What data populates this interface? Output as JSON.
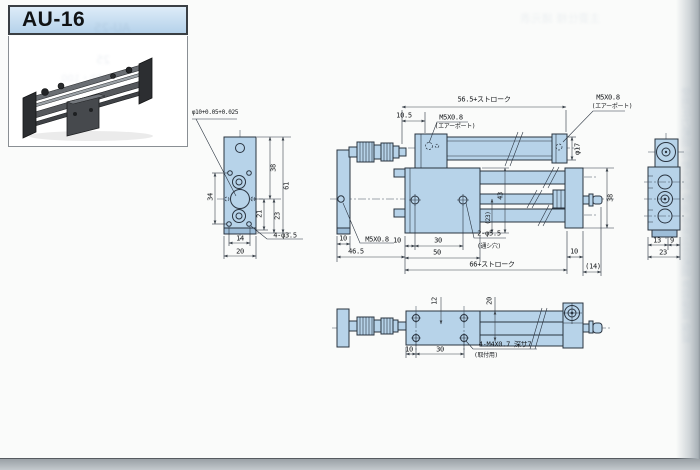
{
  "page": {
    "title": "AU-16"
  },
  "colors": {
    "line": "#2a3440",
    "dim": "#3c444c",
    "fill": "#b7d3e9",
    "fill2": "#9dbdd8",
    "page": "#fafbfa",
    "banner1": "#ddecf8",
    "banner2": "#b5d2ea",
    "ghost": "#7b93ae"
  },
  "labels": [
    {
      "t": "φ10+0.05+0.025",
      "x": 215,
      "y": 113,
      "s": 6
    },
    {
      "t": "34",
      "x": 211,
      "y": 197,
      "r": 1
    },
    {
      "t": "38",
      "x": 274,
      "y": 168,
      "r": 1
    },
    {
      "t": "61",
      "x": 287,
      "y": 186,
      "r": 1
    },
    {
      "t": "21",
      "x": 260,
      "y": 214,
      "r": 1
    },
    {
      "t": "23",
      "x": 278,
      "y": 216,
      "r": 1
    },
    {
      "t": "14",
      "x": 240,
      "y": 239
    },
    {
      "t": "20",
      "x": 240,
      "y": 252
    },
    {
      "t": "4-φ3.5",
      "x": 285,
      "y": 236
    },
    {
      "t": "56.5+ストローク",
      "x": 484,
      "y": 100
    },
    {
      "t": "10.5",
      "x": 404,
      "y": 116
    },
    {
      "t": "M5X0.8",
      "x": 451,
      "y": 118
    },
    {
      "t": "(エアーポート)",
      "x": 455,
      "y": 127,
      "s": 6
    },
    {
      "t": "M5X0.8",
      "x": 608,
      "y": 98
    },
    {
      "t": "(エアーポート)",
      "x": 612,
      "y": 107,
      "s": 6
    },
    {
      "t": "φ17",
      "x": 578,
      "y": 149,
      "r": 1
    },
    {
      "t": "10",
      "x": 343,
      "y": 239
    },
    {
      "t": "M5X0.8",
      "x": 377,
      "y": 240
    },
    {
      "t": "46.5",
      "x": 356,
      "y": 252
    },
    {
      "t": "10",
      "x": 397,
      "y": 241
    },
    {
      "t": "30",
      "x": 438,
      "y": 241
    },
    {
      "t": "50",
      "x": 437,
      "y": 253
    },
    {
      "t": "2-φ5.5",
      "x": 489,
      "y": 234
    },
    {
      "t": "(通シ穴)",
      "x": 489,
      "y": 247,
      "s": 6
    },
    {
      "t": "66+ストローク",
      "x": 492,
      "y": 265
    },
    {
      "t": "43",
      "x": 501,
      "y": 196,
      "r": 1
    },
    {
      "t": "(23)",
      "x": 489,
      "y": 218,
      "r": 1,
      "s": 6
    },
    {
      "t": "38",
      "x": 611,
      "y": 198,
      "r": 1
    },
    {
      "t": "10",
      "x": 574,
      "y": 252
    },
    {
      "t": "(14)",
      "x": 593,
      "y": 267
    },
    {
      "t": "13",
      "x": 657,
      "y": 241
    },
    {
      "t": "9",
      "x": 672,
      "y": 241
    },
    {
      "t": "23",
      "x": 663,
      "y": 253
    },
    {
      "t": "12",
      "x": 435,
      "y": 301,
      "r": 1
    },
    {
      "t": "20",
      "x": 490,
      "y": 301,
      "r": 1
    },
    {
      "t": "10",
      "x": 409,
      "y": 350
    },
    {
      "t": "30",
      "x": 440,
      "y": 350
    },
    {
      "t": "4-M4X0.7 深サ7",
      "x": 505,
      "y": 345
    },
    {
      "t": "(取付用)",
      "x": 486,
      "y": 356,
      "s": 6
    }
  ],
  "ghosts": [
    {
      "t": "AU-25",
      "x": 112,
      "y": 28,
      "s": 12,
      "o": 0.18
    },
    {
      "t": "25",
      "x": 103,
      "y": 60,
      "s": 11,
      "o": 0.14
    },
    {
      "t": "50・100",
      "x": 82,
      "y": 77,
      "s": 10,
      "o": 0.12
    },
    {
      "t": "使用圧力範囲 作動方式 給油 使用温度範囲 許容速度 保証",
      "x": 688,
      "y": 215,
      "s": 10,
      "o": 0.14,
      "vert": 1
    },
    {
      "t": "主要仕様 諸元表",
      "x": 560,
      "y": 18,
      "s": 11,
      "o": 0.1
    }
  ]
}
